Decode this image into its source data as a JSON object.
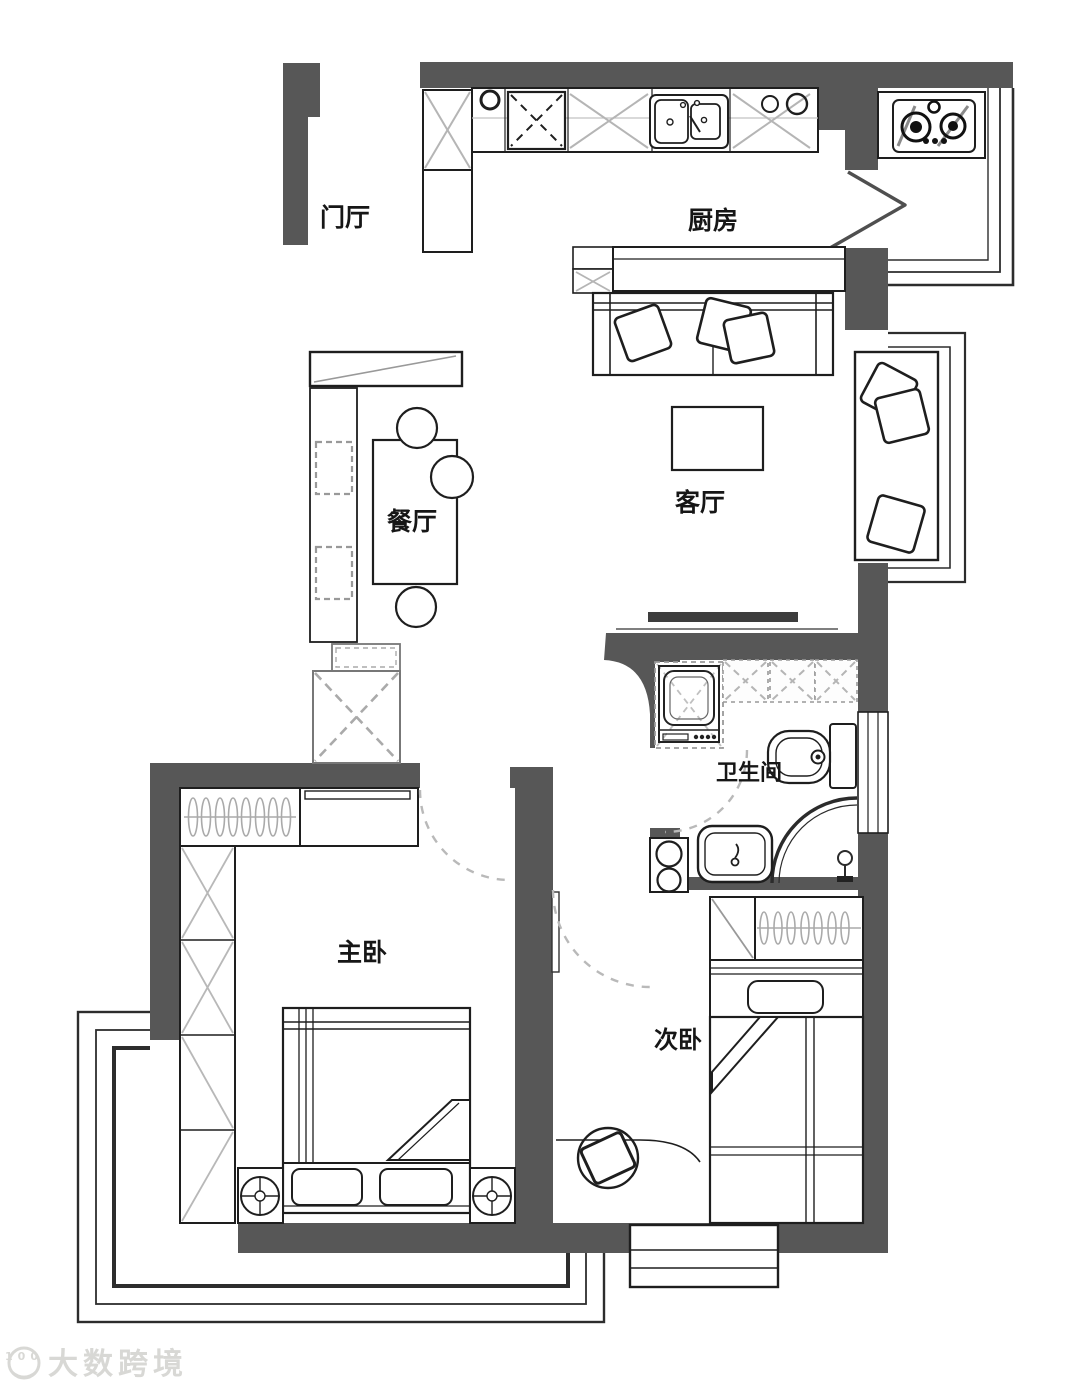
{
  "title": "两室一厅户型图",
  "rooms": {
    "entry": {
      "label": "门厅"
    },
    "kitchen": {
      "label": "厨房"
    },
    "dining": {
      "label": "餐厅"
    },
    "living": {
      "label": "客厅"
    },
    "bathroom": {
      "label": "卫生间"
    },
    "master_bedroom": {
      "label": "主卧"
    },
    "second_bedroom": {
      "label": "次卧"
    }
  },
  "watermark": {
    "logo_text": "100",
    "text": "大数跨境"
  },
  "colors": {
    "wall": "#575757",
    "line": "#1e1e1e",
    "light_line": "#b5b5b5",
    "dash_arc": "#b9b9b9",
    "floor": "#ffffff",
    "watermark": "#d8d8d5"
  }
}
